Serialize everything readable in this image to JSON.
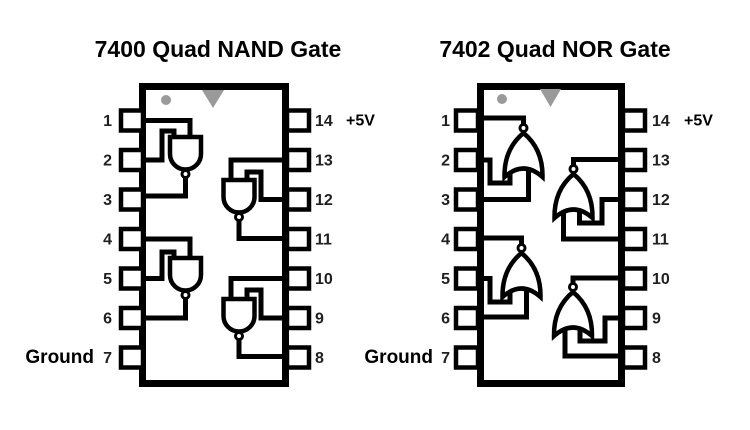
{
  "background": "#ffffff",
  "colors": {
    "ink": "#000000",
    "marker_gray": "#9a9a9a",
    "pin_number_text": "#1f1f1f"
  },
  "icons": {
    "pin1_marker": "gray-dot",
    "orientation_notch": "gray-triangle-down",
    "inverter_bubble": "small-open-circle"
  },
  "chips": [
    {
      "part_number": "7400",
      "title": "7400 Quad NAND Gate",
      "gate_type": "NAND",
      "left_pins": [
        "1",
        "2",
        "3",
        "4",
        "5",
        "6",
        "7"
      ],
      "right_pins": [
        "14",
        "13",
        "12",
        "11",
        "10",
        "9",
        "8"
      ],
      "power_label": "+5V",
      "power_pin": "14",
      "ground_label": "Ground",
      "ground_pin": "7",
      "gates": [
        {
          "inputs": [
            "1",
            "2"
          ],
          "output": "3"
        },
        {
          "inputs": [
            "13",
            "12"
          ],
          "output": "11"
        },
        {
          "inputs": [
            "4",
            "5"
          ],
          "output": "6"
        },
        {
          "inputs": [
            "10",
            "9"
          ],
          "output": "8"
        }
      ]
    },
    {
      "part_number": "7402",
      "title": "7402 Quad NOR Gate",
      "gate_type": "NOR",
      "left_pins": [
        "1",
        "2",
        "3",
        "4",
        "5",
        "6",
        "7"
      ],
      "right_pins": [
        "14",
        "13",
        "12",
        "11",
        "10",
        "9",
        "8"
      ],
      "power_label": "+5V",
      "power_pin": "14",
      "ground_label": "Ground",
      "ground_pin": "7",
      "gates": [
        {
          "inputs": [
            "2",
            "3"
          ],
          "output": "1"
        },
        {
          "inputs": [
            "12",
            "11"
          ],
          "output": "13"
        },
        {
          "inputs": [
            "5",
            "6"
          ],
          "output": "4"
        },
        {
          "inputs": [
            "9",
            "8"
          ],
          "output": "10"
        }
      ]
    }
  ]
}
